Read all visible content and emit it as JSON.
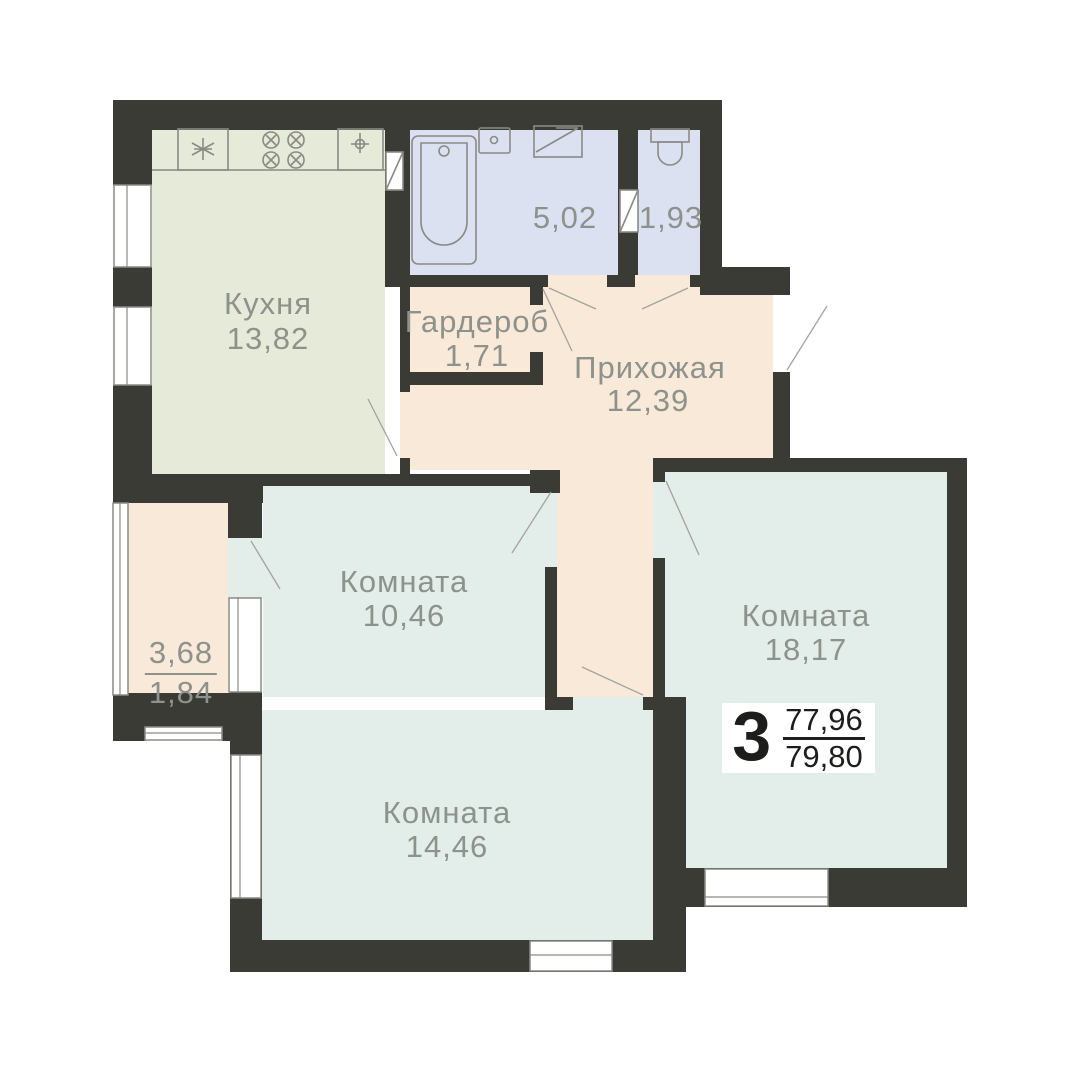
{
  "palette": {
    "wall": "#3b3b36",
    "kitchen": "#e5ead9",
    "wet": "#dce1f1",
    "hall": "#f8e9d8",
    "room": "#e3ede9",
    "label": "#8d928d",
    "line": "#8a8a85",
    "swing": "#a3a39d",
    "badge_text": "#1d1d1b"
  },
  "rooms": {
    "kitchen": {
      "name": "Кухня",
      "area": "13,82"
    },
    "bathroom": {
      "area": "5,02"
    },
    "toilet": {
      "area": "1,93"
    },
    "wardrobe": {
      "name": "Гардероб",
      "area": "1,71"
    },
    "hallway": {
      "name": "Прихожая",
      "area": "12,39"
    },
    "bedroom_small": {
      "name": "Комната",
      "area": "10,46"
    },
    "bedroom_large": {
      "name": "Комната",
      "area": "18,17"
    },
    "bedroom_mid": {
      "name": "Комната",
      "area": "14,46"
    },
    "balcony": {
      "area_total": "3,68",
      "area_reduced": "1,84"
    }
  },
  "badge": {
    "rooms_count": "3",
    "area_top": "77,96",
    "area_bottom": "79,80"
  }
}
